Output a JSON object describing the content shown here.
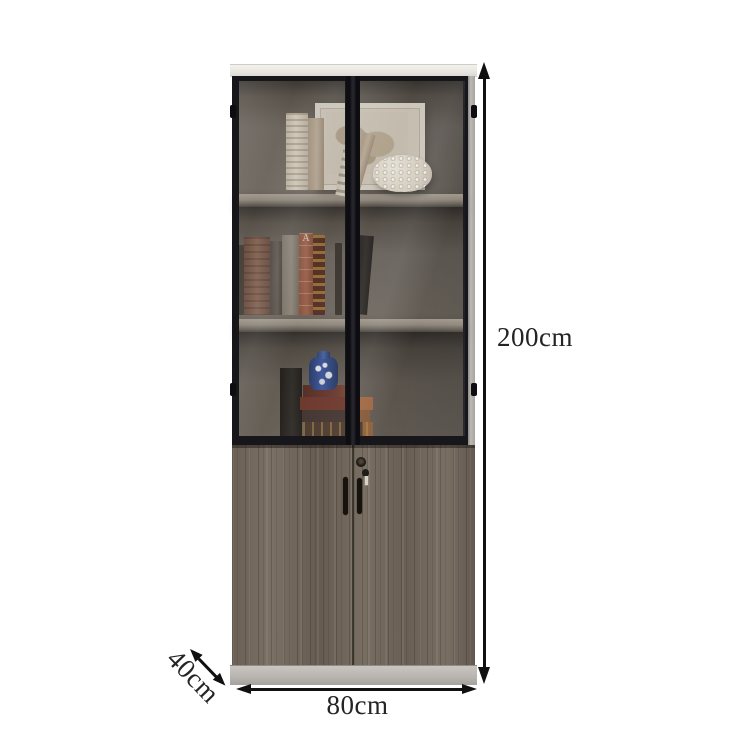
{
  "scene": {
    "type": "product-dimension-diagram",
    "product": "bookcase cabinet with upper glass display doors and lower wood doors"
  },
  "dimensions": {
    "height": "200cm",
    "width": "80cm",
    "depth": "40cm"
  },
  "decor": {
    "book_spine_letter": "A"
  },
  "colors": {
    "background": "#ffffff",
    "frame_black": "#17161b",
    "interior_back": "#6b645b",
    "shelf": "#968d80",
    "wood_door": "#71665b",
    "top_panel": "#ece9e4",
    "base_plinth": "#b7b4af",
    "dimension_line": "#101010",
    "label_text": "#242424"
  }
}
